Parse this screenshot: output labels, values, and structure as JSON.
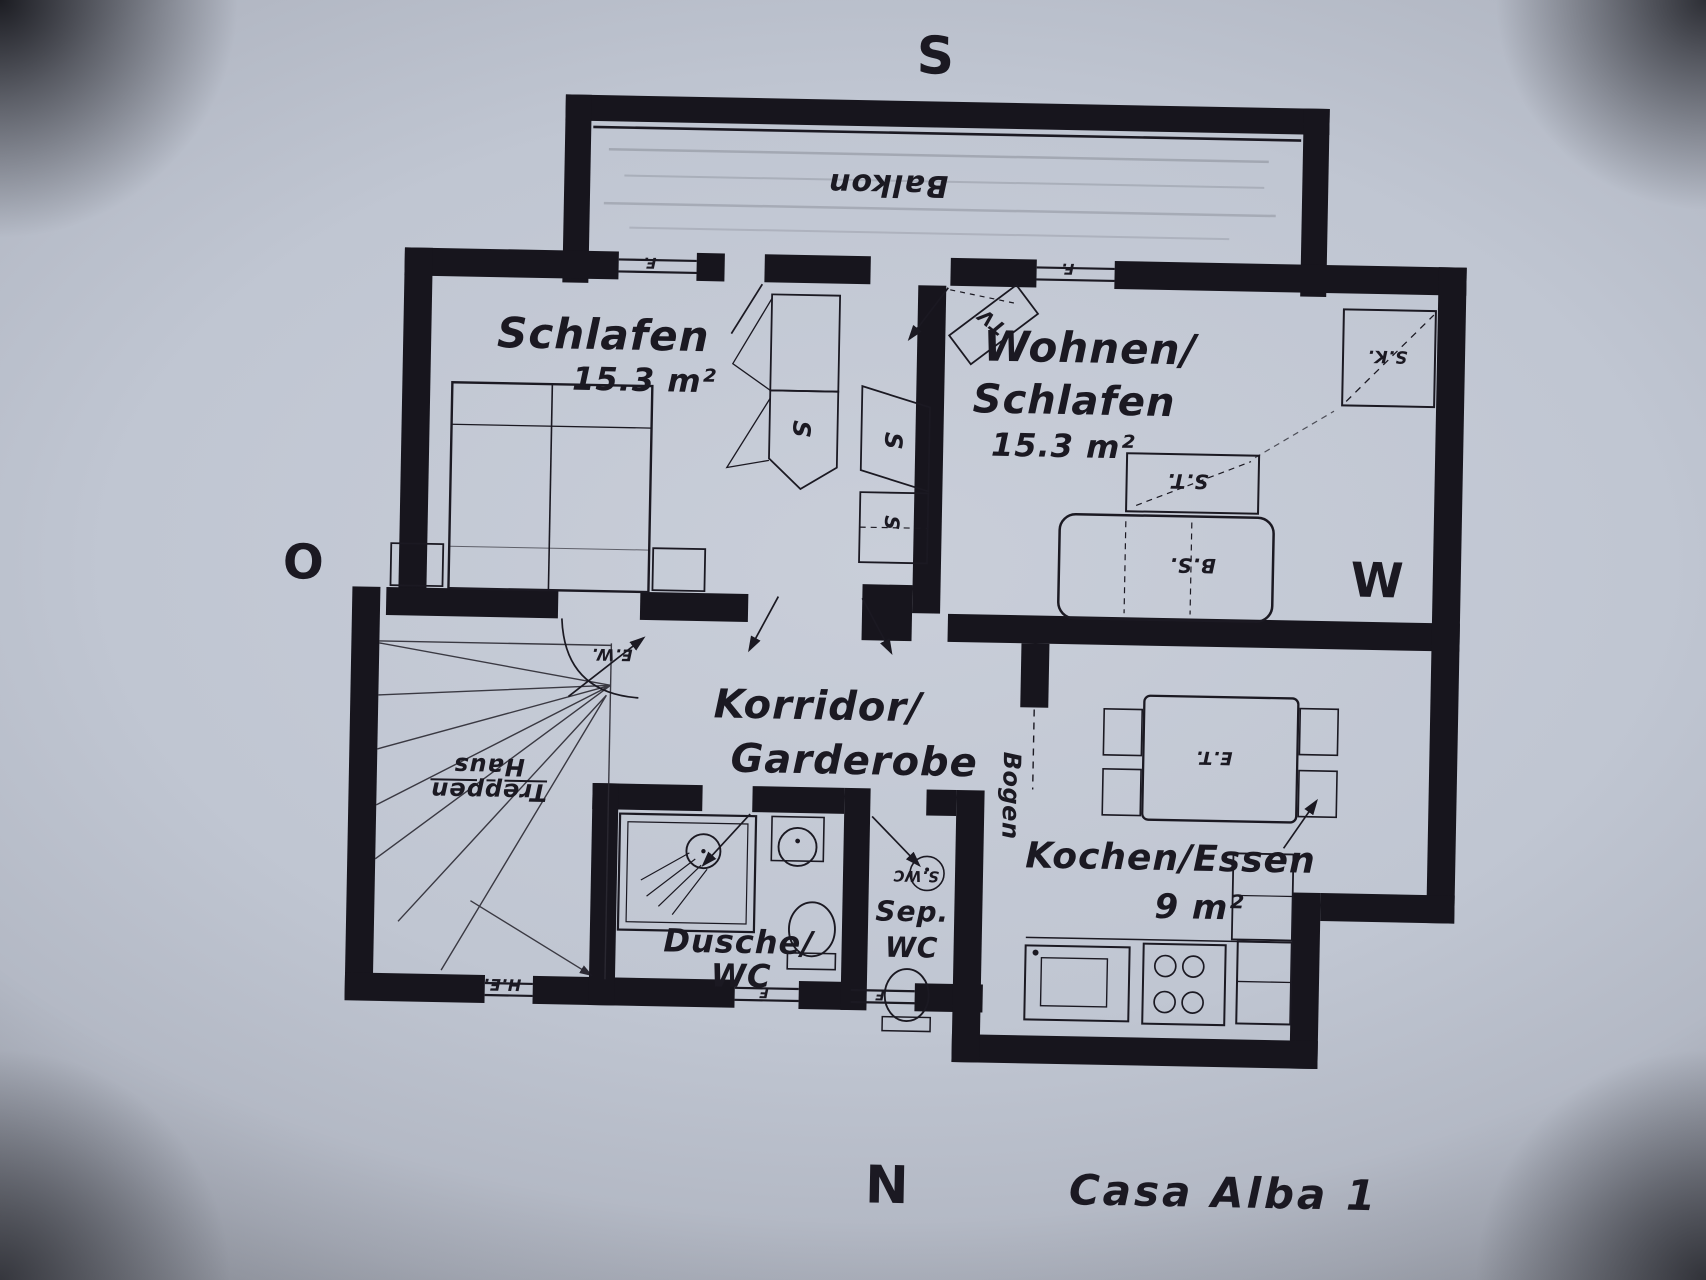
{
  "compass": {
    "south": "S",
    "east": "O",
    "west": "W",
    "north": "N"
  },
  "plan_title": "Casa Alba 1",
  "balcony": {
    "label": "Balkon"
  },
  "rooms": {
    "schlafen": {
      "name": "Schlafen",
      "area": "15.3 m²"
    },
    "wohnen": {
      "line1": "Wohnen/",
      "line2": "Schlafen",
      "area": "15.3 m²"
    },
    "korridor": {
      "line1": "Korridor/",
      "line2": "Garderobe"
    },
    "kochen": {
      "name": "Kochen/Essen",
      "area": "9 m²"
    },
    "dusche": {
      "line1": "Dusche/",
      "line2": "WC"
    },
    "sep_wc": {
      "line1": "Sep.",
      "line2": "WC",
      "wall_note": "S.WC"
    },
    "treppenhaus": {
      "line1": "Treppen",
      "line2": "Haus"
    }
  },
  "furniture_labels": {
    "wardrobe_left": "S",
    "wardrobe_right": "S",
    "wardrobe_lower": "S",
    "tv": "TV",
    "corner_unit": "S.K.",
    "side_table": "S.T.",
    "sofa_bed": "B.S.",
    "dining_table": "E.T.",
    "arch": "Bogen"
  },
  "wall_marks": {
    "window_schlafen": "F.",
    "window_wohnen": "F.",
    "door_schlafen": "E.W.",
    "house_entry": "H.E.",
    "window_bath": "F",
    "window_wc": "F"
  }
}
